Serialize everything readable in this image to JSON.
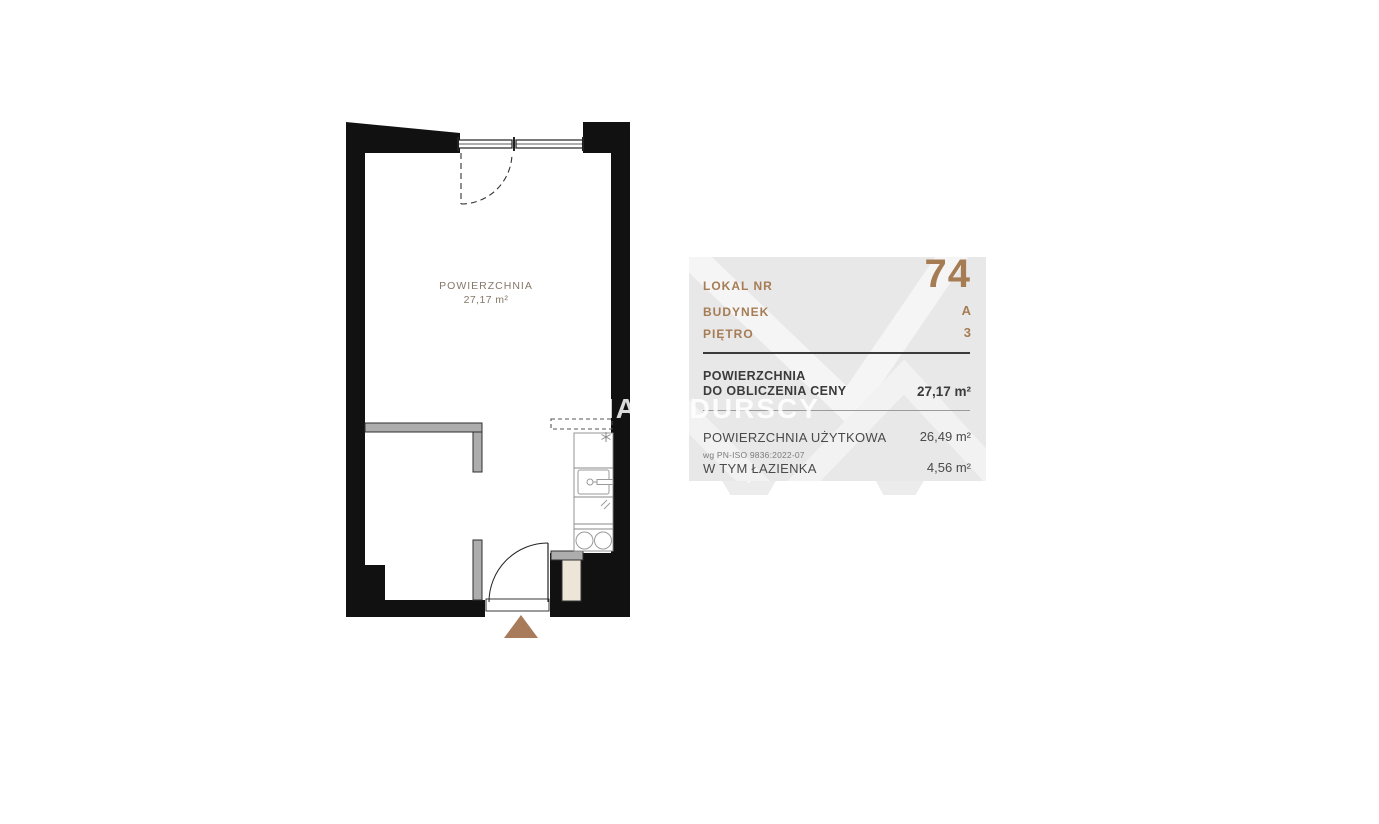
{
  "floor_plan": {
    "room_label": "POWIERZCHNIA",
    "room_area": "27,17 m²"
  },
  "watermark": {
    "text": "IA SADURSCY"
  },
  "info_panel": {
    "unit": {
      "label": "LOKAL NR",
      "value": "74"
    },
    "building": {
      "label": "BUDYNEK",
      "value": "A"
    },
    "floor": {
      "label": "PIĘTRO",
      "value": "3"
    },
    "price_area": {
      "label_line1": "POWIERZCHNIA",
      "label_line2": "DO OBLICZENIA CENY",
      "value": "27,17 m²"
    },
    "usable_area": {
      "label": "POWIERZCHNIA UŻYTKOWA",
      "note": "wg PN-ISO 9836:2022-07",
      "value": "26,49 m²"
    },
    "bathroom_area": {
      "label": "W TYM ŁAZIENKA",
      "value": "4,56 m²"
    },
    "colors": {
      "accent": "#A57C54",
      "panel_bg": "#E9E8E8",
      "text_dark": "#3B3B3B",
      "wall_black": "#111111"
    }
  }
}
